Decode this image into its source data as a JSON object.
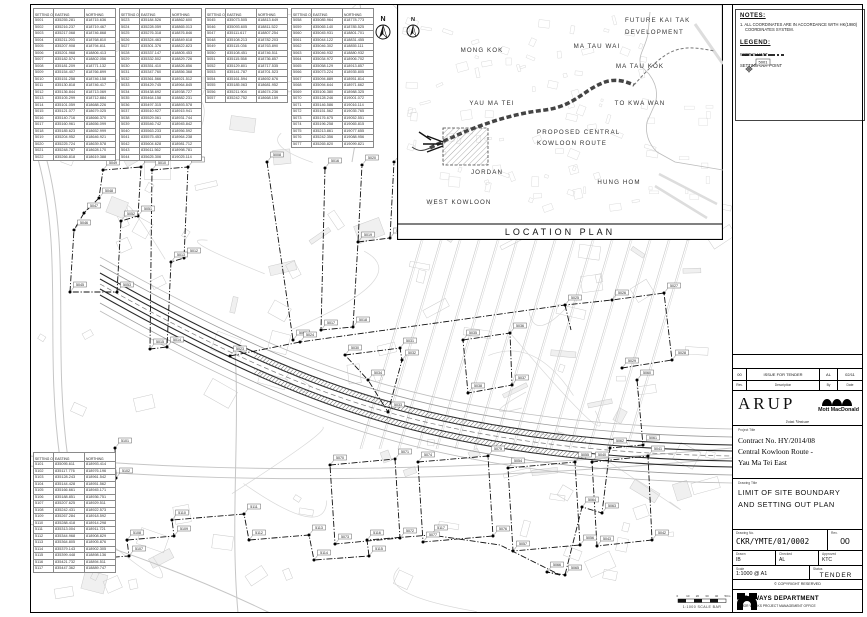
{
  "plan": {
    "north_label": "N",
    "scale_bar_label": "1:1000 SCALE BAR",
    "scale_bar_ticks": [
      "0",
      "10",
      "20",
      "30",
      "40",
      "50m"
    ]
  },
  "location_plan": {
    "caption": "LOCATION PLAN",
    "north_label": "N",
    "labels": [
      {
        "text": "MONG KOK",
        "x": 85,
        "y": 48,
        "a": "middle"
      },
      {
        "text": "MA TAU WAI",
        "x": 200,
        "y": 44,
        "a": "middle"
      },
      {
        "text": "MA TAU KOK",
        "x": 243,
        "y": 64,
        "a": "middle"
      },
      {
        "text": "YAU MA TEI",
        "x": 95,
        "y": 101,
        "a": "middle"
      },
      {
        "text": "TO KWA WAN",
        "x": 243,
        "y": 101,
        "a": "middle"
      },
      {
        "text": "PROPOSED CENTRAL",
        "x": 140,
        "y": 130,
        "a": "start"
      },
      {
        "text": "KOWLOON ROUTE",
        "x": 140,
        "y": 141,
        "a": "start"
      },
      {
        "text": "JORDAN",
        "x": 90,
        "y": 170,
        "a": "middle"
      },
      {
        "text": "HUNG HOM",
        "x": 222,
        "y": 180,
        "a": "middle"
      },
      {
        "text": "WEST KOWLOON",
        "x": 62,
        "y": 200,
        "a": "middle"
      },
      {
        "text": "FUTURE KAI TAK",
        "x": 228,
        "y": 18,
        "a": "start"
      },
      {
        "text": "DEVELOPMENT",
        "x": 228,
        "y": 30,
        "a": "start"
      }
    ]
  },
  "notes": {
    "heading": "NOTES:",
    "line1": "1. ALL COORDINATES ARE IN ACCORDANCE WITH HK(1980)",
    "line2": "COORDINATES SYSTEM."
  },
  "legend": {
    "heading": "LEGEND:",
    "works_limit": "WORKS LIMIT",
    "setting_out": "SETTING OUT POINT",
    "example_id": "5001"
  },
  "title_block": {
    "revision": {
      "row": [
        "00",
        "ISSUE FOR TENDER",
        "AL",
        "02/11"
      ],
      "headers": [
        "Rev.",
        "Description",
        "By",
        "Date"
      ]
    },
    "consultant": {
      "arup": "ARUP",
      "mott": "Mott MacDonald",
      "jv": "Joint Venture"
    },
    "project": {
      "label": "Project Title",
      "contract": "Contract No. HY/2014/08",
      "line1": "Central Kowloon Route -",
      "line2": "Yau Ma Tei East"
    },
    "drawing": {
      "label": "Drawing Title",
      "line1": "LIMIT OF SITE BOUNDARY",
      "line2": "AND SETTING OUT PLAN"
    },
    "number": {
      "label": "Drawing No.",
      "value": "CKR/YMTE/01/0002",
      "rev_label": "Rev.",
      "rev": "00"
    },
    "staff": {
      "drawn_label": "Drawn",
      "drawn": "IB",
      "checked_label": "Checked",
      "checked": "AL",
      "approved_label": "Approved",
      "approved": "KTC"
    },
    "scale": {
      "label": "Scale",
      "value": "1:1000 @ A1",
      "status_label": "Status",
      "status": "TENDER"
    },
    "copyright": "© COPYRIGHT RESERVED",
    "department": {
      "name": "HIGHWAYS DEPARTMENT",
      "office": "MAJOR WORKS PROJECT MANAGEMENT OFFICE"
    }
  },
  "tables": {
    "headers": [
      "SETTING OUT POINT",
      "EASTING",
      "NORTHING"
    ],
    "groups": [
      {
        "rows": [
          [
            "5001",
            "835255.281",
            "818715.636"
          ],
          [
            "5002",
            "835216.237",
            "818719.467"
          ],
          [
            "5003",
            "835217.068",
            "818746.868"
          ],
          [
            "5004",
            "835211.293",
            "818768.810"
          ],
          [
            "5005",
            "835207.908",
            "818794.811"
          ],
          [
            "5006",
            "835201.968",
            "818806.413"
          ],
          [
            "5007",
            "835182.574",
            "818802.056"
          ],
          [
            "5008",
            "835181.209",
            "818771.132"
          ],
          [
            "5009",
            "835154.407",
            "818766.899"
          ],
          [
            "5010",
            "835151.258",
            "818746.158"
          ],
          [
            "5011",
            "835130.818",
            "818746.417"
          ],
          [
            "5012",
            "835136.844",
            "818713.069"
          ],
          [
            "5013",
            "835105.299",
            "818712.884"
          ],
          [
            "5014",
            "835101.059",
            "818688.226"
          ],
          [
            "5015",
            "835121.077",
            "818679.025"
          ],
          [
            "5016",
            "835140.716",
            "818666.370"
          ],
          [
            "5017",
            "835160.961",
            "818656.099"
          ],
          [
            "5018",
            "835185.623",
            "818652.999"
          ],
          [
            "5019",
            "835204.952",
            "818646.921"
          ],
          [
            "5020",
            "835225.724",
            "818639.578"
          ],
          [
            "5021",
            "835248.787",
            "818628.170"
          ],
          [
            "5022",
            "835266.818",
            "818619.388"
          ]
        ]
      },
      {
        "rows": [
          [
            "5023",
            "835184.526",
            "818862.600"
          ],
          [
            "5024",
            "835228.059",
            "818865.013"
          ],
          [
            "5025",
            "835276.318",
            "818876.846"
          ],
          [
            "5026",
            "835324.463",
            "818849.618"
          ],
          [
            "5027",
            "835301.376",
            "818822.823"
          ],
          [
            "5028",
            "835337.147",
            "818805.453"
          ],
          [
            "5029",
            "835332.502",
            "818829.726"
          ],
          [
            "5030",
            "835351.410",
            "818826.856"
          ],
          [
            "5031",
            "835347.760",
            "818856.368"
          ],
          [
            "5032",
            "835361.566",
            "818921.512"
          ],
          [
            "5033",
            "835429.745",
            "818964.845"
          ],
          [
            "5034",
            "835438.692",
            "818938.727"
          ],
          [
            "5035",
            "835464.158",
            "818882.231"
          ],
          [
            "5036",
            "835497.315",
            "818893.578"
          ],
          [
            "5037",
            "835510.927",
            "818915.941"
          ],
          [
            "5038",
            "835529.061",
            "818931.744"
          ],
          [
            "5039",
            "835546.742",
            "818945.842"
          ],
          [
            "5040",
            "835563.233",
            "818956.592"
          ],
          [
            "5041",
            "835575.453",
            "818964.238"
          ],
          [
            "5042",
            "835604.628",
            "818981.712"
          ],
          [
            "5043",
            "835611.562",
            "818998.781"
          ],
          [
            "5044",
            "835625.306",
            "819025.114"
          ]
        ]
      },
      {
        "rows": [
          [
            "5045",
            "835073.505",
            "818813.649"
          ],
          [
            "5046",
            "835093.605",
            "818811.522"
          ],
          [
            "5047",
            "835111.617",
            "818807.254"
          ],
          [
            "5048",
            "835108.213",
            "818782.203"
          ],
          [
            "5049",
            "835115.036",
            "818763.890"
          ],
          [
            "5050",
            "835108.451",
            "818746.511"
          ],
          [
            "5051",
            "835115.558",
            "818736.857"
          ],
          [
            "5052",
            "835129.801",
            "818717.535"
          ],
          [
            "5053",
            "835141.787",
            "818701.523"
          ],
          [
            "5054",
            "835161.594",
            "818692.676"
          ],
          [
            "5055",
            "835185.063",
            "818681.952"
          ],
          [
            "5056",
            "835211.904",
            "818674.236"
          ],
          [
            "5057",
            "835242.752",
            "818668.159"
          ]
        ]
      },
      {
        "rows": [
          [
            "5058",
            "835085.964",
            "818778.773"
          ],
          [
            "5059",
            "835065.140",
            "818785.525"
          ],
          [
            "5060",
            "835045.931",
            "818801.701"
          ],
          [
            "5061",
            "835044.122",
            "818831.455"
          ],
          [
            "5062",
            "835046.302",
            "818855.111"
          ],
          [
            "5063",
            "835046.932",
            "818880.932"
          ],
          [
            "5064",
            "835034.972",
            "818906.702"
          ],
          [
            "5065",
            "835058.129",
            "818913.857"
          ],
          [
            "5066",
            "835073.224",
            "818935.805"
          ],
          [
            "5067",
            "835094.889",
            "818951.814"
          ],
          [
            "5068",
            "835094.644",
            "818971.662"
          ],
          [
            "5069",
            "835106.380",
            "818988.325"
          ],
          [
            "5070",
            "835128.246",
            "819001.072"
          ],
          [
            "5071",
            "835146.586",
            "819016.114"
          ],
          [
            "5072",
            "835151.562",
            "819035.765"
          ],
          [
            "5073",
            "835176.675",
            "819052.551"
          ],
          [
            "5074",
            "835196.258",
            "819065.815"
          ],
          [
            "5075",
            "835213.861",
            "819077.655"
          ],
          [
            "5076",
            "835242.356",
            "819088.956"
          ],
          [
            "5077",
            "835265.820",
            "819099.821"
          ]
        ]
      },
      {
        "rows": [
          [
            "5101",
            "835095.611",
            "818993.414"
          ],
          [
            "5102",
            "835117.776",
            "818976.196"
          ],
          [
            "5103",
            "835128.243",
            "818961.542"
          ],
          [
            "5104",
            "835144.428",
            "818951.562"
          ],
          [
            "5105",
            "835166.661",
            "818945.171"
          ],
          [
            "5106",
            "835188.851",
            "818936.751"
          ],
          [
            "5107",
            "835207.625",
            "818929.511"
          ],
          [
            "5108",
            "835242.431",
            "818922.573"
          ],
          [
            "5109",
            "835267.284",
            "818918.592"
          ],
          [
            "5110",
            "835288.418",
            "818914.298"
          ],
          [
            "5111",
            "835313.004",
            "818911.721"
          ],
          [
            "5112",
            "835344.968",
            "818908.829"
          ],
          [
            "5113",
            "835364.805",
            "818905.876"
          ],
          [
            "5114",
            "835379.143",
            "818902.305"
          ],
          [
            "5115",
            "835399.448",
            "818898.136"
          ],
          [
            "5116",
            "835421.732",
            "818894.511"
          ],
          [
            "5117",
            "835447.362",
            "818889.747"
          ]
        ]
      }
    ]
  },
  "plan_markers": [
    [
      "5045",
      40,
      288
    ],
    [
      "5046",
      44,
      226
    ],
    [
      "5047",
      54,
      209
    ],
    [
      "5048",
      69,
      194
    ],
    [
      "5049",
      73,
      166
    ],
    [
      "5050",
      111,
      163
    ],
    [
      "5051",
      108,
      212
    ],
    [
      "5052",
      91,
      217
    ],
    [
      "5053",
      87,
      288
    ],
    [
      "5010",
      122,
      166
    ],
    [
      "5011",
      158,
      163
    ],
    [
      "5012",
      154,
      254
    ],
    [
      "5013",
      141,
      258
    ],
    [
      "5014",
      137,
      343
    ],
    [
      "5015",
      120,
      345
    ],
    [
      "5016",
      295,
      164
    ],
    [
      "5017",
      291,
      326
    ],
    [
      "5018",
      323,
      323
    ],
    [
      "5019",
      328,
      238
    ],
    [
      "5020",
      332,
      161
    ],
    [
      "5021",
      360,
      234
    ],
    [
      "5022",
      364,
      158
    ],
    [
      "5008",
      237,
      158
    ],
    [
      "5009",
      263,
      336
    ],
    [
      "5023",
      200,
      352
    ],
    [
      "5024",
      270,
      338
    ],
    [
      "5025",
      535,
      301
    ],
    [
      "5026",
      582,
      296
    ],
    [
      "5027",
      634,
      289
    ],
    [
      "5028",
      642,
      356
    ],
    [
      "5029",
      592,
      364
    ],
    [
      "5030",
      315,
      351
    ],
    [
      "5031",
      370,
      344
    ],
    [
      "5032",
      372,
      356
    ],
    [
      "5033",
      358,
      408
    ],
    [
      "5034",
      338,
      376
    ],
    [
      "5035",
      433,
      336
    ],
    [
      "5036",
      480,
      329
    ],
    [
      "5037",
      482,
      381
    ],
    [
      "5038",
      438,
      389
    ],
    [
      "5101",
      85,
      444
    ],
    [
      "5102",
      86,
      474
    ],
    [
      "5103",
      66,
      478
    ],
    [
      "5104",
      68,
      524
    ],
    [
      "5105",
      46,
      527
    ],
    [
      "5106",
      48,
      556
    ],
    [
      "5107",
      99,
      552
    ],
    [
      "5108",
      97,
      536
    ],
    [
      "5109",
      144,
      532
    ],
    [
      "5110",
      142,
      516
    ],
    [
      "5111",
      214,
      510
    ],
    [
      "5112",
      219,
      536
    ],
    [
      "5113",
      279,
      531
    ],
    [
      "5114",
      284,
      556
    ],
    [
      "5115",
      339,
      552
    ],
    [
      "5116",
      337,
      536
    ],
    [
      "5117",
      401,
      531
    ],
    [
      "5060",
      607,
      376
    ],
    [
      "5061",
      613,
      441
    ],
    [
      "5062",
      580,
      444
    ],
    [
      "5063",
      572,
      509
    ],
    [
      "5064",
      552,
      503
    ],
    [
      "5065",
      535,
      571
    ],
    [
      "5066",
      517,
      568
    ],
    [
      "5070",
      300,
      461
    ],
    [
      "5071",
      365,
      455
    ],
    [
      "5072",
      370,
      534
    ],
    [
      "5073",
      305,
      540
    ],
    [
      "5074",
      388,
      458
    ],
    [
      "5075",
      458,
      452
    ],
    [
      "5076",
      463,
      532
    ],
    [
      "5077",
      393,
      538
    ],
    [
      "5054",
      478,
      464
    ],
    [
      "5055",
      545,
      458
    ],
    [
      "5056",
      550,
      541
    ],
    [
      "5057",
      483,
      547
    ],
    [
      "5040",
      562,
      458
    ],
    [
      "5041",
      618,
      452
    ],
    [
      "5042",
      622,
      536
    ],
    [
      "5043",
      567,
      542
    ]
  ]
}
